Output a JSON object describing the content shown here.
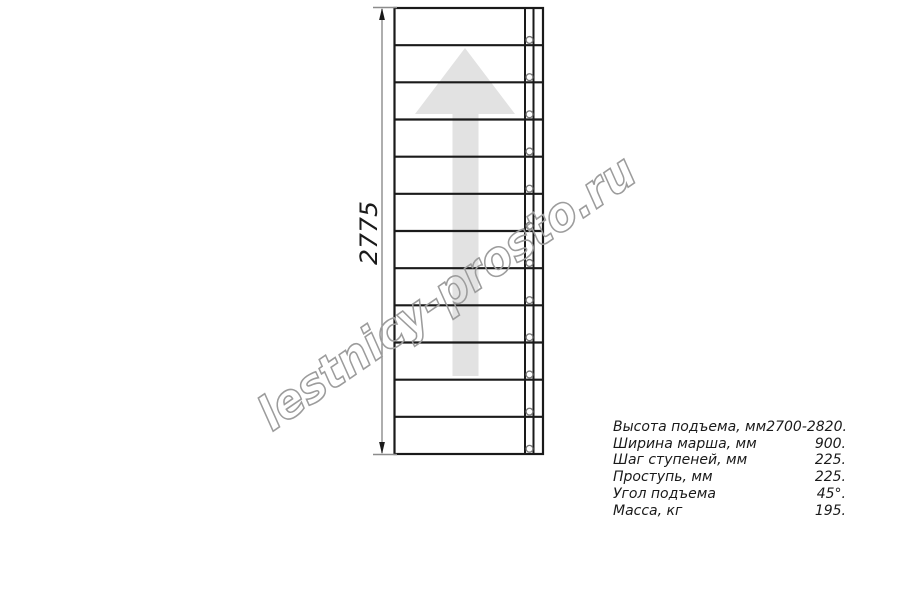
{
  "diagram": {
    "dimension_label": "2775",
    "step_count": 12,
    "colors": {
      "line": "#1a1a1a",
      "dim_line": "#8c8c8c",
      "arrow_fill": "#e2e2e2",
      "circle_stroke": "#777777",
      "watermark": "#9c9c9c",
      "text": "#1a1a1a"
    }
  },
  "watermark": {
    "text": "lestnicy-prosto.ru"
  },
  "specs": {
    "rows": [
      {
        "label": "Высота подъема, мм",
        "value": "2700-2820."
      },
      {
        "label": "Ширина марша, мм",
        "value": "900."
      },
      {
        "label": "Шаг ступеней, мм",
        "value": "225."
      },
      {
        "label": "Проступь, мм",
        "value": "225."
      },
      {
        "label": "Угол подъема",
        "value": "45°."
      },
      {
        "label": "Масса, кг",
        "value": "195."
      }
    ]
  }
}
